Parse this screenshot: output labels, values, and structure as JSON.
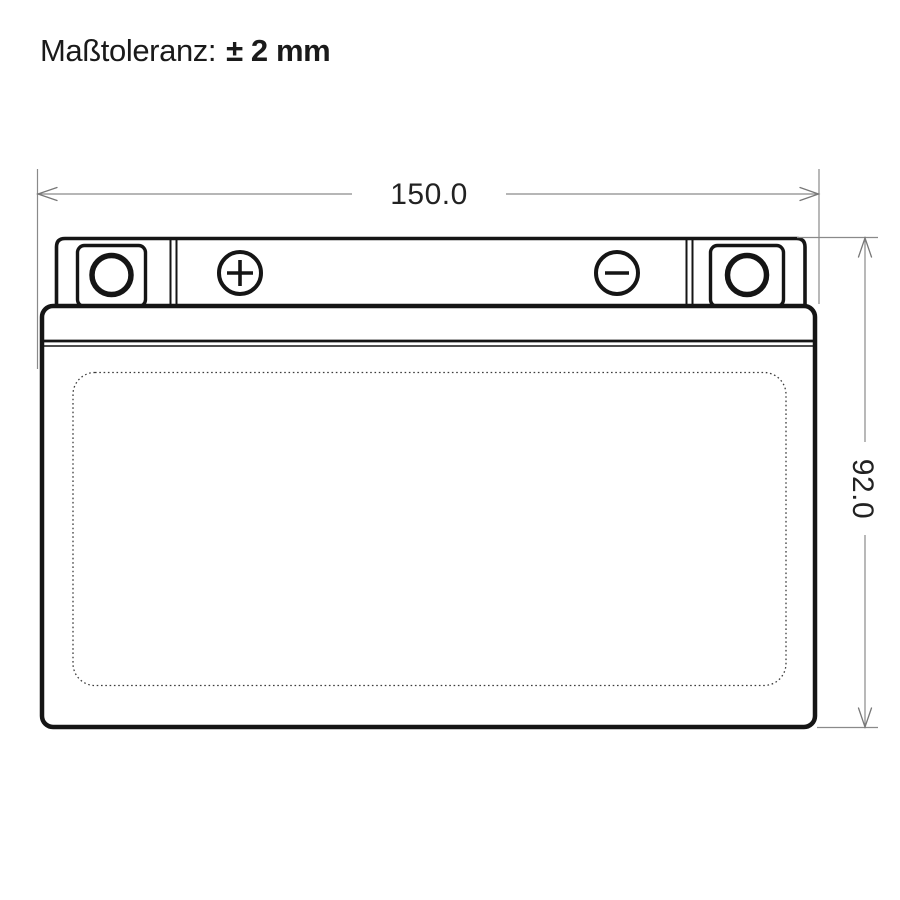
{
  "header": {
    "tolerance_label": "Maßtoleranz:",
    "tolerance_value": "± 2 mm"
  },
  "diagram": {
    "type": "battery-dimension-drawing",
    "width_dimension": {
      "value": "150.0",
      "orientation": "horizontal"
    },
    "height_dimension": {
      "value": "92.0",
      "orientation": "vertical-rotated-90cw"
    },
    "battery": {
      "positive_terminal_symbol": "+",
      "negative_terminal_symbol": "−",
      "left_post_icon": "terminal-post-circle",
      "right_post_icon": "terminal-post-circle",
      "label_area_style": "dotted-rounded-rectangle"
    },
    "colors": {
      "outline": "#151515",
      "dimension_line": "#8a8a8a",
      "dimension_text": "#222222",
      "background": "#ffffff"
    }
  }
}
